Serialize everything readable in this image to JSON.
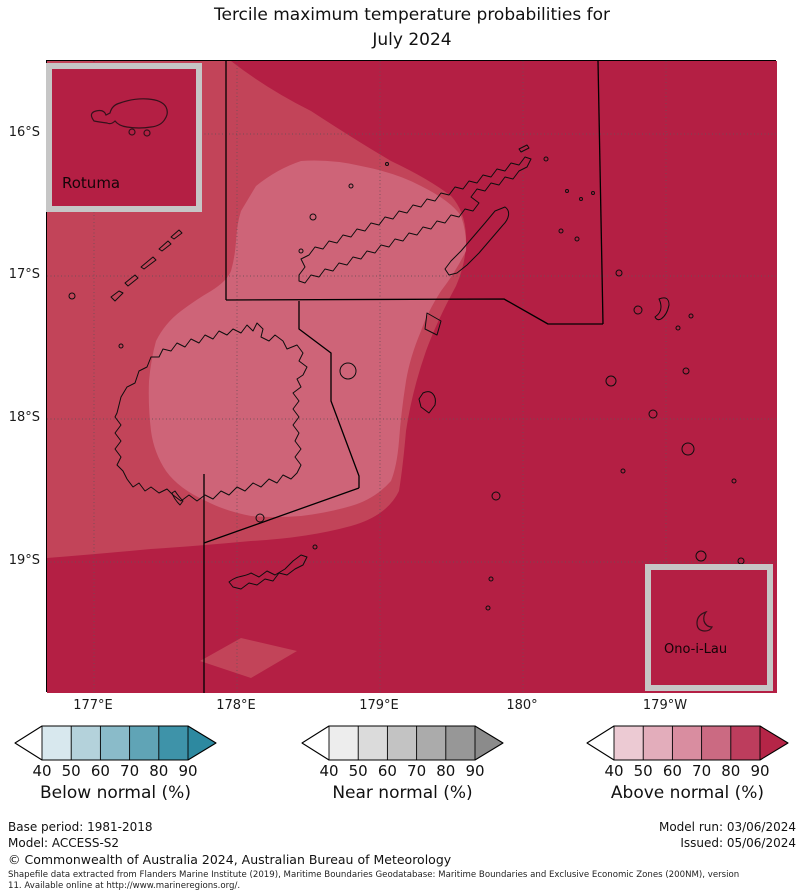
{
  "title": {
    "line1": "Tercile maximum temperature probabilities for",
    "line2": "July 2024"
  },
  "map": {
    "lat_ticks": [
      "16°S",
      "17°S",
      "18°S",
      "19°S"
    ],
    "lon_ticks": [
      "177°E",
      "178°E",
      "179°E",
      "180°",
      "179°W"
    ],
    "insets": [
      {
        "label": "Rotuma"
      },
      {
        "label": "Ono-i-Lau"
      }
    ],
    "colors": {
      "probability_above_90": "#b41f44",
      "probability_70_80": "#c24459",
      "probability_60_70": "#ce6478",
      "inset_border": "#c6c6c6",
      "coastline": "#0d0d0d",
      "eez_boundary": "#000000"
    }
  },
  "legend": {
    "scales": [
      {
        "name": "below",
        "caption": "Below normal (%)",
        "ticks": [
          "40",
          "50",
          "60",
          "70",
          "80",
          "90"
        ],
        "segment_colors": [
          "#d8e8ee",
          "#b4d2db",
          "#8abbc9",
          "#60a4b6",
          "#3e93a9"
        ],
        "tip_color": "#2d89a0",
        "left_tip_color": "#ffffff"
      },
      {
        "name": "near",
        "caption": "Near normal (%)",
        "ticks": [
          "40",
          "50",
          "60",
          "70",
          "80",
          "90"
        ],
        "segment_colors": [
          "#ededed",
          "#dbdbdb",
          "#c3c3c3",
          "#ababab",
          "#979797"
        ],
        "tip_color": "#8b8b8b",
        "left_tip_color": "#ffffff"
      },
      {
        "name": "above",
        "caption": "Above normal (%)",
        "ticks": [
          "40",
          "50",
          "60",
          "70",
          "80",
          "90"
        ],
        "segment_colors": [
          "#eccad3",
          "#e3adbb",
          "#d98da0",
          "#cb6a82",
          "#bd3d5d"
        ],
        "tip_color": "#b52547",
        "left_tip_color": "#ffffff"
      }
    ]
  },
  "footer": {
    "base_period": "Base period: 1981-2018",
    "model": "Model: ACCESS-S2",
    "model_run": "Model run: 03/06/2024",
    "issued": "Issued: 05/06/2024",
    "copyright": "© Commonwealth of Australia 2024, Australian Bureau of Meteorology",
    "attribution_line1": "Shapefile data extracted from Flanders Marine Institute (2019), Maritime Boundaries Geodatabase: Maritime Boundaries and Exclusive Economic Zones (200NM), version",
    "attribution_line2": "11. Available online at http://www.marineregions.org/."
  }
}
